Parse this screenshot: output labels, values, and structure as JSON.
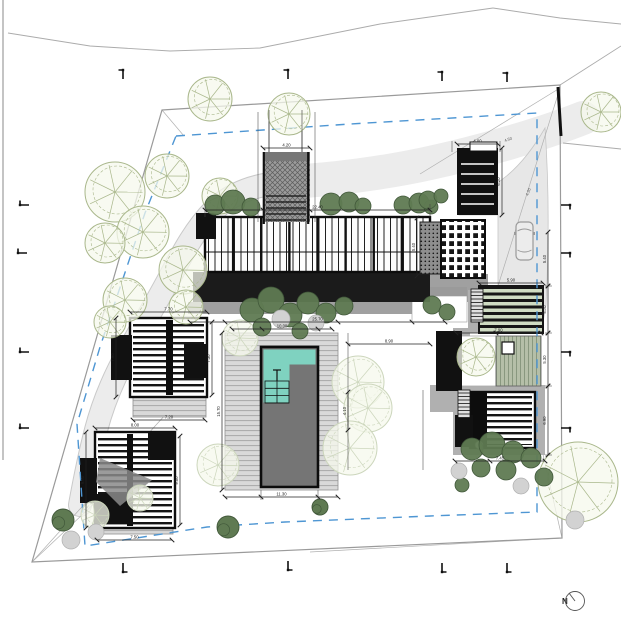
{
  "north": {
    "label": "N"
  },
  "colors": {
    "boundary": "#9a9a9a",
    "setback": "#4e96d3",
    "stream_fill": "#ececec",
    "stream_edge": "#c9c9c9",
    "drive_fill": "#e7e7e7",
    "ink": "#141414",
    "walk": "#a0a0a0",
    "platform": "#b0b0b0",
    "pool_water": "#757575",
    "pool_shallow": "#7fd2c0",
    "shrub": "#5f7a52",
    "shrub_dk": "#41583a",
    "shrub_gray": "#d2d2d2",
    "tree_stroke": "#a9b78b",
    "tree_fill": "#f6f8ec",
    "tree_faint": "#ccd6bc",
    "dim": "#222222",
    "road": "#ababab",
    "survey": "#b0b0b0"
  },
  "site": {
    "boundary": [
      [
        162,
        110
      ],
      [
        560,
        85
      ],
      [
        562,
        538
      ],
      [
        32,
        562
      ]
    ],
    "boundary_wall": [
      558,
      87,
      561,
      136
    ],
    "setback": [
      [
        176,
        136
      ],
      [
        350,
        124
      ],
      [
        537,
        113
      ],
      [
        537,
        512
      ],
      [
        430,
        516
      ],
      [
        285,
        522
      ],
      [
        207,
        527
      ],
      [
        85,
        546
      ],
      [
        77,
        424
      ],
      [
        100,
        347
      ],
      [
        145,
        213
      ]
    ],
    "frame": [
      3,
      0,
      3,
      460
    ],
    "roads": [
      [
        [
          8,
          33
        ],
        [
          90,
          46
        ],
        [
          170,
          51
        ],
        [
          260,
          48
        ],
        [
          380,
          24
        ],
        [
          493,
          8
        ]
      ],
      [
        [
          493,
          8
        ],
        [
          560,
          18
        ],
        [
          621,
          24
        ]
      ],
      [
        [
          560,
          85
        ],
        [
          621,
          46
        ]
      ],
      [
        [
          563,
          143
        ],
        [
          621,
          149
        ]
      ]
    ],
    "survey": [
      [
        560,
        88,
        420,
        174
      ],
      [
        560,
        88,
        488,
        318
      ],
      [
        32,
        562,
        166,
        414
      ],
      [
        32,
        562,
        100,
        498
      ],
      [
        562,
        538,
        537,
        428
      ],
      [
        562,
        538,
        310,
        552
      ],
      [
        162,
        110,
        184,
        136
      ]
    ],
    "survey_labels": [
      {
        "t": "4.50",
        "x": 505,
        "y": 142,
        "rot": -20
      },
      {
        "t": "4.20",
        "x": 528,
        "y": 196,
        "rot": -68
      }
    ]
  },
  "landscape": {
    "stream": "M583,118 C540,135 480,152 430,163 C385,173 330,180 288,182 C255,184 232,193 214,210 C196,228 183,252 170,277 C156,303 142,327 128,352 C114,377 103,403 96,430 C89,457 84,483 80,505",
    "wash": "M583,118 C540,135 480,152 430,163 C385,173 330,180 288,182",
    "drive": "M545,128 C549,185 549,245 546,305 L543,322 L470,322 L470,292 L498,290 L498,215 L459,215 L459,198 C495,192 522,168 545,128 Z",
    "trees": [
      {
        "x": 210,
        "y": 99,
        "r": 22,
        "k": 0
      },
      {
        "x": 289,
        "y": 114,
        "r": 21,
        "k": 0
      },
      {
        "x": 601,
        "y": 112,
        "r": 20,
        "k": 0
      },
      {
        "x": 115,
        "y": 192,
        "r": 30,
        "k": 0
      },
      {
        "x": 167,
        "y": 176,
        "r": 22,
        "k": 0
      },
      {
        "x": 220,
        "y": 196,
        "r": 18,
        "k": 0
      },
      {
        "x": 143,
        "y": 232,
        "r": 26,
        "k": 0
      },
      {
        "x": 105,
        "y": 243,
        "r": 20,
        "k": 0
      },
      {
        "x": 183,
        "y": 270,
        "r": 24,
        "k": 0
      },
      {
        "x": 125,
        "y": 300,
        "r": 22,
        "k": 0
      },
      {
        "x": 186,
        "y": 307,
        "r": 17,
        "k": 0
      },
      {
        "x": 110,
        "y": 322,
        "r": 16,
        "k": 0
      },
      {
        "x": 476,
        "y": 357,
        "r": 19,
        "k": 0
      },
      {
        "x": 578,
        "y": 482,
        "r": 40,
        "k": 0
      },
      {
        "x": 358,
        "y": 382,
        "r": 26,
        "k": 1
      },
      {
        "x": 368,
        "y": 408,
        "r": 24,
        "k": 1
      },
      {
        "x": 350,
        "y": 448,
        "r": 27,
        "k": 1
      },
      {
        "x": 218,
        "y": 465,
        "r": 21,
        "k": 1
      },
      {
        "x": 240,
        "y": 338,
        "r": 18,
        "k": 1
      },
      {
        "x": 95,
        "y": 515,
        "r": 14,
        "k": 1
      },
      {
        "x": 140,
        "y": 498,
        "r": 13,
        "k": 1
      },
      {
        "x": 228,
        "y": 527,
        "r": 11,
        "k": 2
      },
      {
        "x": 320,
        "y": 507,
        "r": 8,
        "k": 2
      },
      {
        "x": 63,
        "y": 520,
        "r": 11,
        "k": 2
      }
    ],
    "shrubs": [
      [
        215,
        205,
        10
      ],
      [
        233,
        202,
        12
      ],
      [
        251,
        207,
        9
      ],
      [
        331,
        204,
        11
      ],
      [
        349,
        202,
        10
      ],
      [
        363,
        206,
        8
      ],
      [
        403,
        205,
        9
      ],
      [
        419,
        203,
        10
      ],
      [
        431,
        207,
        7
      ],
      [
        428,
        200,
        9
      ],
      [
        441,
        196,
        7
      ],
      [
        252,
        310,
        12
      ],
      [
        271,
        300,
        13
      ],
      [
        290,
        315,
        12
      ],
      [
        308,
        303,
        11
      ],
      [
        326,
        313,
        10
      ],
      [
        344,
        306,
        9
      ],
      [
        262,
        327,
        9
      ],
      [
        300,
        331,
        8
      ],
      [
        432,
        305,
        9
      ],
      [
        447,
        312,
        8
      ],
      [
        472,
        449,
        11
      ],
      [
        492,
        445,
        13
      ],
      [
        513,
        452,
        11
      ],
      [
        531,
        458,
        10
      ],
      [
        481,
        468,
        9
      ],
      [
        506,
        470,
        10
      ],
      [
        544,
        477,
        9
      ],
      [
        462,
        485,
        7
      ]
    ],
    "shrubs_gray": [
      [
        281,
        319,
        9
      ],
      [
        316,
        323,
        8
      ],
      [
        459,
        471,
        8
      ],
      [
        521,
        486,
        8
      ],
      [
        71,
        540,
        9
      ],
      [
        96,
        532,
        8
      ],
      [
        575,
        520,
        9
      ]
    ]
  },
  "structures": {
    "grays": [
      {
        "r": [
          188,
          302,
          262,
          12
        ],
        "c": "#a0a0a0"
      },
      {
        "r": [
          413,
          274,
          75,
          28
        ],
        "c": "#a0a0a0"
      },
      {
        "r": [
          412,
          287,
          55,
          9
        ],
        "c": "#9a9a9a"
      },
      {
        "r": [
          453,
          385,
          92,
          70
        ],
        "c": "#b0b0b0"
      },
      {
        "r": [
          453,
          328,
          17,
          60
        ],
        "c": "#b0b0b0"
      },
      {
        "r": [
          430,
          385,
          45,
          27
        ],
        "c": "#b0b0b0"
      },
      {
        "r": [
          468,
          290,
          14,
          43
        ],
        "c": "#b0b0b0"
      }
    ],
    "court_white": [
      412,
      296,
      55,
      26
    ],
    "white_patio": [
      456,
      336,
      40,
      50
    ],
    "decks": [
      [
        225,
        333,
        113,
        157
      ],
      [
        178,
        318,
        29,
        24
      ],
      [
        133,
        397,
        73,
        20
      ],
      [
        97,
        514,
        76,
        20
      ]
    ],
    "dark_band": [
      193,
      272,
      237,
      30
    ],
    "glass_bar": [
      205,
      217,
      225,
      55
    ],
    "dot_patio": [
      420,
      222,
      33,
      52
    ],
    "room_block": [
      441,
      220,
      44,
      58
    ],
    "louvers": [
      [
        470,
        392,
        65,
        56
      ],
      [
        130,
        318,
        77,
        79
      ],
      [
        95,
        432,
        80,
        96
      ]
    ],
    "spines": [
      [
        166,
        320,
        7,
        75
      ],
      [
        127,
        434,
        6,
        92
      ],
      [
        470,
        392,
        17,
        56
      ]
    ],
    "solids": [
      [
        196,
        213,
        20,
        26
      ],
      [
        436,
        331,
        26,
        60
      ],
      [
        111,
        335,
        21,
        45
      ],
      [
        184,
        344,
        23,
        34
      ],
      [
        80,
        458,
        17,
        45
      ],
      [
        148,
        432,
        27,
        28
      ],
      [
        95,
        494,
        38,
        30
      ],
      [
        455,
        415,
        18,
        32
      ]
    ],
    "wedge": [
      [
        100,
        458
      ],
      [
        152,
        480
      ],
      [
        120,
        506
      ],
      [
        96,
        482
      ]
    ],
    "pergola": [
      479,
      286,
      64,
      47
    ],
    "green_deck": [
      496,
      336,
      45,
      50
    ],
    "table": [
      502,
      342,
      12,
      12
    ],
    "garage": {
      "rect": [
        457,
        148,
        41,
        67
      ],
      "stripes_y": [
        164,
        174,
        184,
        194,
        204
      ],
      "stripe_x": [
        461,
        494
      ],
      "notch": [
        470,
        142,
        27,
        9
      ]
    },
    "bridge": {
      "rect": [
        263,
        152,
        47,
        70
      ],
      "landing": [
        263,
        152,
        47,
        9
      ],
      "rails": [
        263.8,
        308.2
      ],
      "rungs": [
        196,
        222
      ],
      "rung_x": [
        266,
        306
      ]
    },
    "ladders": [
      [
        458,
        390,
        12,
        28
      ],
      [
        471,
        289,
        12,
        33
      ]
    ],
    "fixture": [
      479,
      445,
      4
    ],
    "pool_deck": [
      225,
      333,
      113,
      157
    ],
    "pool": {
      "rect": [
        261,
        347,
        57,
        140
      ],
      "shallow": [
        [
          263.5,
          349.5,
          52,
          15
        ],
        [
          263.5,
          364.5,
          26,
          38
        ]
      ],
      "steps": [
        265,
        381,
        24,
        22
      ],
      "grid_x": [
        277
      ],
      "grid_y": [
        388.3,
        395.6,
        402.9
      ],
      "ladder": [
        277,
        370,
        277,
        381
      ]
    },
    "car": {
      "x": 516,
      "y": 222,
      "w": 17,
      "h": 38
    }
  },
  "dims": [
    [
      205,
      210,
      430,
      210,
      "22.40",
      [
        263,
        310
      ]
    ],
    [
      263,
      148,
      310,
      148,
      "4.20",
      []
    ],
    [
      457,
      144,
      498,
      144,
      "4.00",
      []
    ],
    [
      502,
      148,
      502,
      215,
      "6.20",
      []
    ],
    [
      548,
      232,
      548,
      286,
      "5.40",
      []
    ],
    [
      548,
      286,
      548,
      333,
      "4.70",
      []
    ],
    [
      548,
      333,
      548,
      386,
      "5.30",
      []
    ],
    [
      548,
      386,
      548,
      455,
      "6.90",
      []
    ],
    [
      455,
      461,
      545,
      461,
      "7.45",
      [
        490
      ]
    ],
    [
      222,
      333,
      222,
      490,
      "15.70",
      []
    ],
    [
      225,
      497,
      338,
      497,
      "11.30",
      [
        261,
        318
      ]
    ],
    [
      232,
      329,
      332,
      329,
      "10.00",
      [
        262,
        318
      ]
    ],
    [
      190,
      322,
      445,
      322,
      "25.70",
      [
        225,
        338,
        412
      ]
    ],
    [
      116,
      318,
      116,
      397,
      "7.90",
      []
    ],
    [
      130,
      312,
      207,
      312,
      "7.70",
      []
    ],
    [
      133,
      420,
      205,
      420,
      "7.20",
      []
    ],
    [
      86,
      432,
      86,
      528,
      "9.60",
      []
    ],
    [
      95,
      428,
      175,
      428,
      "8.00",
      []
    ],
    [
      97,
      540,
      172,
      540,
      "7.50",
      []
    ],
    [
      212,
      322,
      212,
      395,
      "7.30",
      []
    ],
    [
      180,
      436,
      180,
      525,
      "9.00",
      []
    ],
    [
      417,
      218,
      417,
      276,
      "5.40",
      []
    ],
    [
      348,
      344,
      430,
      344,
      "8.90",
      []
    ],
    [
      348,
      392,
      348,
      430,
      "4.10",
      []
    ],
    [
      456,
      333,
      541,
      333,
      "7.90",
      [
        496
      ]
    ],
    [
      479,
      283,
      543,
      283,
      "5.90",
      []
    ]
  ],
  "exts": [
    [
      258,
      112,
      258,
      222
    ],
    [
      315,
      112,
      315,
      222
    ],
    [
      269,
      110,
      269,
      152
    ],
    [
      302,
      110,
      302,
      152
    ],
    [
      261,
      490,
      261,
      500
    ],
    [
      318,
      490,
      318,
      500
    ],
    [
      348,
      333,
      348,
      470
    ],
    [
      423,
      390,
      423,
      470
    ],
    [
      545,
      286,
      552,
      286
    ],
    [
      545,
      333,
      552,
      333
    ],
    [
      545,
      386,
      552,
      386
    ],
    [
      545,
      455,
      552,
      455
    ],
    [
      205,
      204,
      205,
      217
    ],
    [
      430,
      204,
      430,
      217
    ],
    [
      452,
      141,
      452,
      152
    ],
    [
      500,
      141,
      500,
      152
    ]
  ],
  "markers": [
    {
      "x": 123,
      "y": 70,
      "o": "t"
    },
    {
      "x": 288,
      "y": 70,
      "o": "t"
    },
    {
      "x": 442,
      "y": 72,
      "o": "t"
    },
    {
      "x": 507,
      "y": 73,
      "o": "t"
    },
    {
      "x": 123,
      "y": 572,
      "o": "b"
    },
    {
      "x": 288,
      "y": 570,
      "o": "b"
    },
    {
      "x": 442,
      "y": 572,
      "o": "b"
    },
    {
      "x": 507,
      "y": 572,
      "o": "b"
    },
    {
      "x": 20,
      "y": 205,
      "o": "l"
    },
    {
      "x": 18,
      "y": 253,
      "o": "l"
    },
    {
      "x": 20,
      "y": 352,
      "o": "l"
    },
    {
      "x": 20,
      "y": 428,
      "o": "l"
    },
    {
      "x": 570,
      "y": 205,
      "o": "r"
    },
    {
      "x": 570,
      "y": 253,
      "o": "r"
    },
    {
      "x": 570,
      "y": 352,
      "o": "r"
    },
    {
      "x": 570,
      "y": 428,
      "o": "r"
    }
  ]
}
